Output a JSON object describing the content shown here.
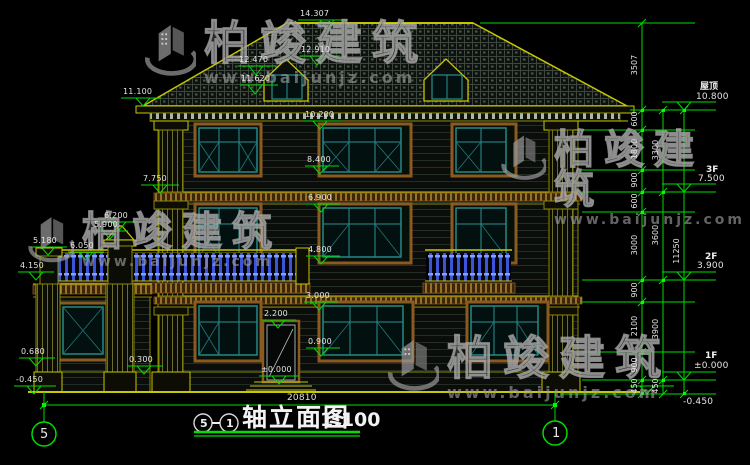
{
  "watermark": {
    "brand": "柏竣建筑",
    "url": "www.baijunjz.com"
  },
  "title_block": {
    "axis_left": "5",
    "separator": "—",
    "axis_right": "1",
    "title": "轴立面图",
    "scale": "1:100"
  },
  "axis_bubbles": {
    "left": "5",
    "right": "1"
  },
  "bottom_dim": {
    "overall_width": "20810"
  },
  "elevation_labels": {
    "peak": "14.307",
    "dormer_ridge": "12.910",
    "dormer_eave": "12.470",
    "dormer_sill": "11.620",
    "left_eave": "11.100",
    "cornice_3f": "10.200",
    "win3_sill": "8.400",
    "band_3f": "7.750",
    "win2_head": "6.900",
    "gate_cap": "6.200",
    "gate_cap_base": "5.900",
    "porch_rail": "6.050",
    "porch_post": "5.180",
    "win2_sill": "4.800",
    "porch_deck": "4.150",
    "win1_head": "3.000",
    "door_head": "2.200",
    "win1_sill": "0.900",
    "porch_wall": "0.680",
    "plinth": "0.300",
    "door_zero": "±0.000",
    "ground_left": "-0.450"
  },
  "right_dims": {
    "col1": [
      "3507",
      "600",
      "1800",
      "900",
      "600",
      "3000",
      "900",
      "2100",
      "900",
      "450"
    ],
    "col2": [
      "3300",
      "3600",
      "3900",
      "450"
    ],
    "col3": [
      "11250"
    ]
  },
  "floor_marks": {
    "roof_label": "屋顶",
    "roof_value": "10.800",
    "f3_label": "3F",
    "f3_value": "7.500",
    "f2_label": "2F",
    "f2_value": "3.900",
    "f1_label": "1F",
    "f1_value": "±0.000",
    "site_value": "-0.450"
  }
}
